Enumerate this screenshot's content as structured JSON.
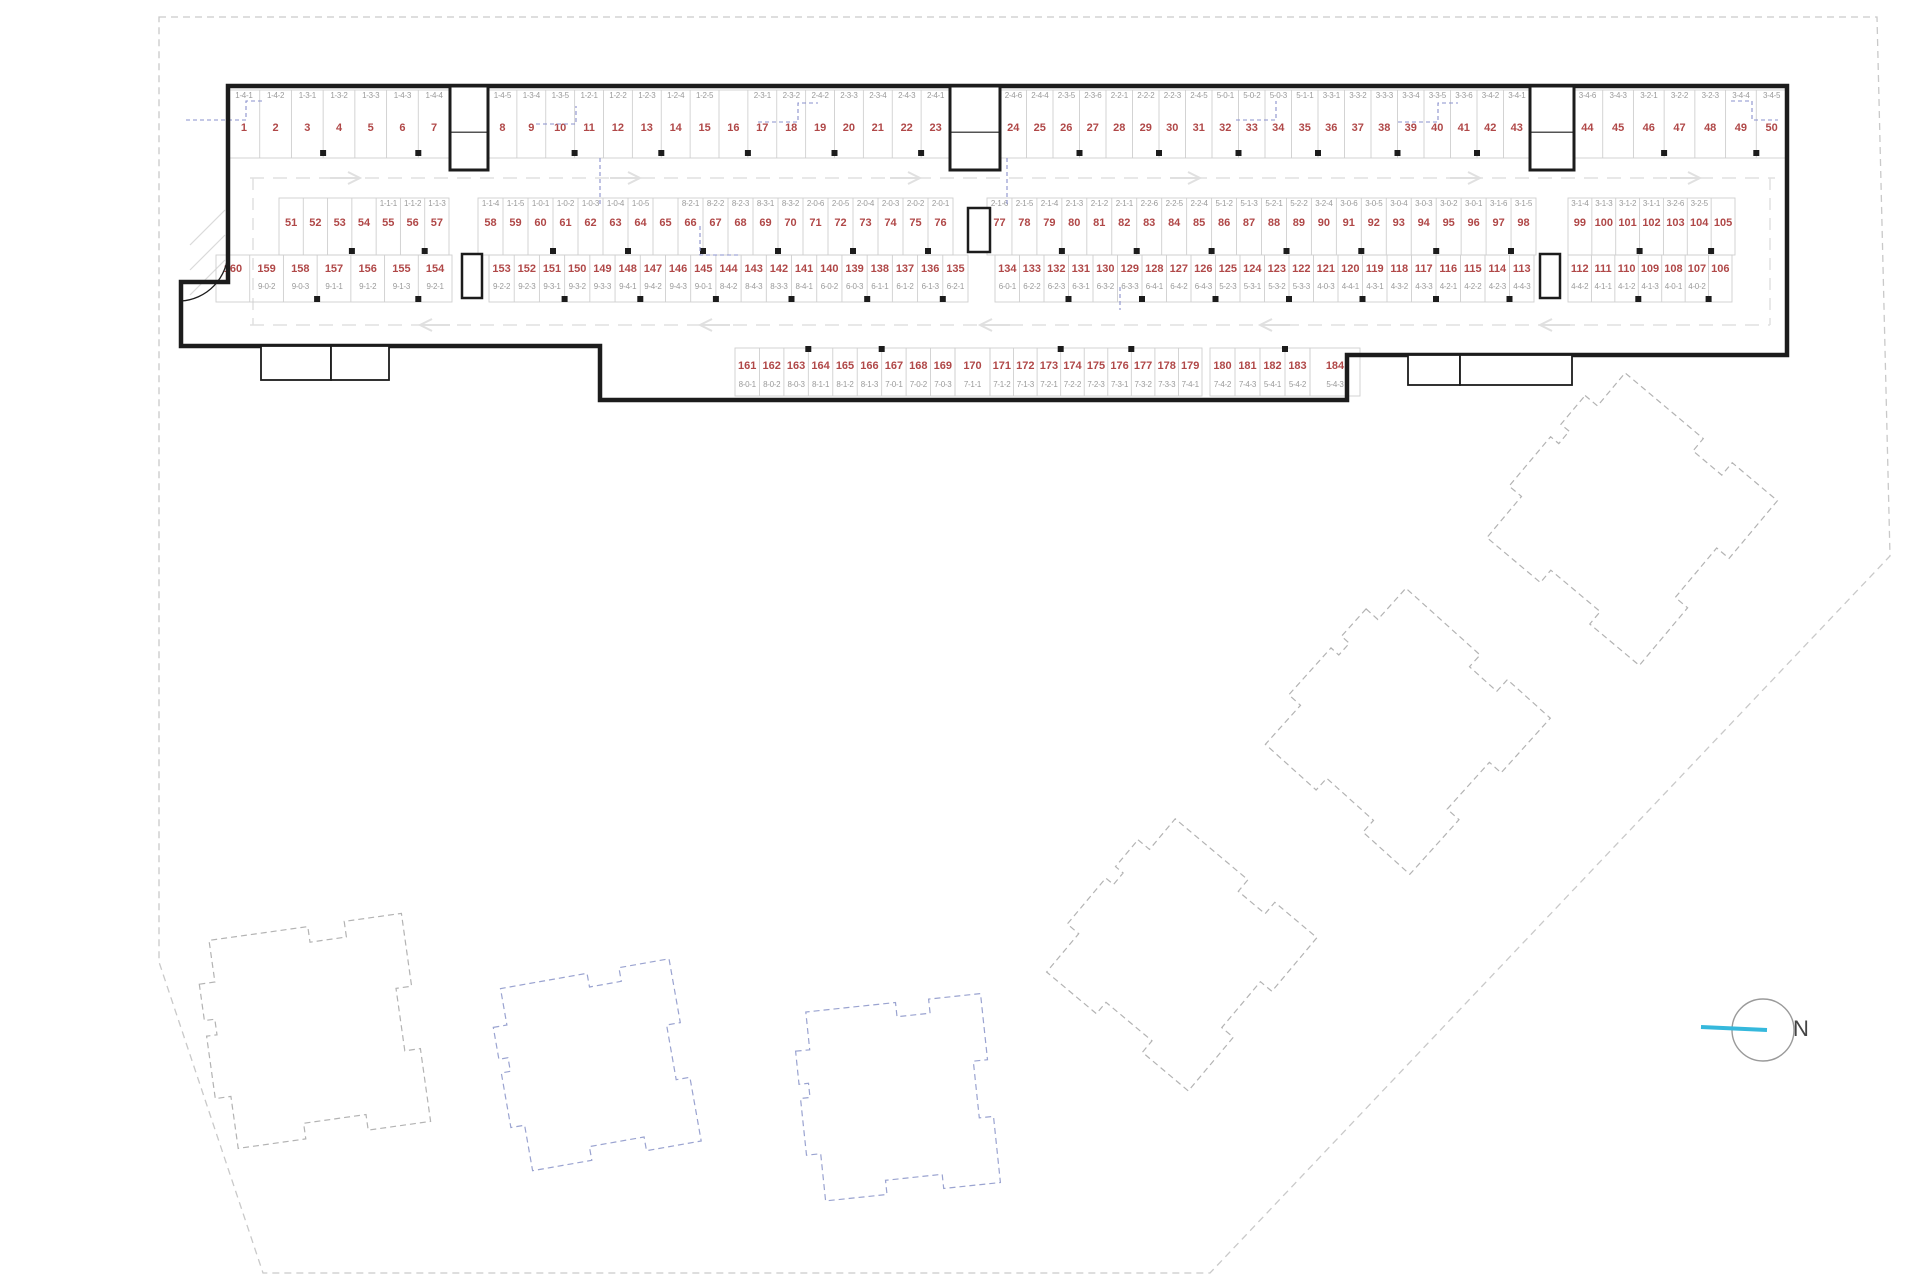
{
  "north_label": "N",
  "colors": {
    "space_number": "#b04848",
    "space_code": "#9a9a9a",
    "wall": "#1c1c1c",
    "divider": "#cfcfcf",
    "lane": "#e0e0e0",
    "blue_dash": "#8a90cc",
    "boundary": "#c9c9c9",
    "north_line": "#35b8dc",
    "building_gray": "#b3b3b3",
    "building_blue": "#9aa3d0"
  },
  "parking_rows": [
    {
      "name": "row-top",
      "num_y": 131,
      "code_y": 98,
      "div_top": 90,
      "div_bottom": 158,
      "frame_top": 88,
      "col_y": 150,
      "groups": [
        {
          "x1": 228,
          "x2": 450,
          "numbers": [
            1,
            2,
            3,
            4,
            5,
            6,
            7
          ],
          "codes": [
            "1-4-1",
            "1-4-2",
            "1-3-1",
            "1-3-2",
            "1-3-3",
            "1-4-3",
            "1-4-4"
          ]
        },
        {
          "x1": 488,
          "x2": 950,
          "numbers": [
            8,
            9,
            10,
            11,
            12,
            13,
            14,
            15,
            16,
            17,
            18,
            19,
            20,
            21,
            22,
            23
          ],
          "codes": [
            "1-4-5",
            "1-3-4",
            "1-3-5",
            "1-2-1",
            "1-2-2",
            "1-2-3",
            "1-2-4",
            "1-2-5",
            "",
            "2-3-1",
            "2-3-2",
            "2-4-2",
            "2-3-3",
            "2-3-4",
            "2-4-3",
            "2-4-1"
          ]
        },
        {
          "x1": 1000,
          "x2": 1530,
          "numbers": [
            24,
            25,
            26,
            27,
            28,
            29,
            30,
            31,
            32,
            33,
            34,
            35,
            36,
            37,
            38,
            39,
            40,
            41,
            42,
            43
          ],
          "codes": [
            "2-4-6",
            "2-4-4",
            "2-3-5",
            "2-3-6",
            "2-2-1",
            "2-2-2",
            "2-2-3",
            "2-4-5",
            "5-0-1",
            "5-0-2",
            "5-0-3",
            "5-1-1",
            "3-3-1",
            "3-3-2",
            "3-3-3",
            "3-3-4",
            "3-3-5",
            "3-3-6",
            "3-4-2",
            "3-4-1"
          ]
        },
        {
          "x1": 1572,
          "x2": 1787,
          "numbers": [
            44,
            45,
            46,
            47,
            48,
            49,
            50
          ],
          "codes": [
            "3-4-6",
            "3-4-3",
            "3-2-1",
            "3-2-2",
            "3-2-3",
            "3-4-4",
            "3-4-5"
          ]
        }
      ]
    },
    {
      "name": "row-mid-upper",
      "num_y": 226,
      "code_y": 206,
      "div_top": 198,
      "div_bottom": 255,
      "col_y": 248,
      "groups": [
        {
          "x1": 279,
          "x2": 449,
          "numbers": [
            51,
            52,
            53,
            54,
            55,
            56,
            57
          ],
          "codes": [
            "",
            "",
            "",
            "",
            "1-1-1",
            "1-1-2",
            "1-1-3"
          ]
        },
        {
          "x1": 478,
          "x2": 953,
          "numbers": [
            58,
            59,
            60,
            61,
            62,
            63,
            64,
            65,
            66,
            67,
            68,
            69,
            70,
            71,
            72,
            73,
            74,
            75,
            76
          ],
          "codes": [
            "1-1-4",
            "1-1-5",
            "1-0-1",
            "1-0-2",
            "1-0-3",
            "1-0-4",
            "1-0-5",
            "",
            "8-2-1",
            "8-2-2",
            "8-2-3",
            "8-3-1",
            "8-3-2",
            "2-0-6",
            "2-0-5",
            "2-0-4",
            "2-0-3",
            "2-0-2",
            "2-0-1"
          ]
        },
        {
          "x1": 987,
          "x2": 1536,
          "numbers": [
            77,
            78,
            79,
            80,
            81,
            82,
            83,
            84,
            85,
            86,
            87,
            88,
            89,
            90,
            91,
            92,
            93,
            94,
            95,
            96,
            97,
            98
          ],
          "codes": [
            "2-1-6",
            "2-1-5",
            "2-1-4",
            "2-1-3",
            "2-1-2",
            "2-1-1",
            "2-2-6",
            "2-2-5",
            "2-2-4",
            "5-1-2",
            "5-1-3",
            "5-2-1",
            "5-2-2",
            "3-2-4",
            "3-0-6",
            "3-0-5",
            "3-0-4",
            "3-0-3",
            "3-0-2",
            "3-0-1",
            "3-1-6",
            "3-1-5"
          ]
        },
        {
          "x1": 1568,
          "x2": 1735,
          "numbers": [
            99,
            100,
            101,
            102,
            103,
            104,
            105
          ],
          "codes": [
            "3-1-4",
            "3-1-3",
            "3-1-2",
            "3-1-1",
            "3-2-6",
            "3-2-5",
            ""
          ]
        }
      ]
    },
    {
      "name": "row-mid-lower",
      "num_y": 272,
      "code_y": 289,
      "div_top": 255,
      "div_bottom": 302,
      "col_y": 296,
      "groups": [
        {
          "x1": 216,
          "x2": 452,
          "numbers": [
            160,
            159,
            158,
            157,
            156,
            155,
            154
          ],
          "codes": [
            "",
            "9-0-2",
            "9-0-3",
            "9-1-1",
            "9-1-2",
            "9-1-3",
            "9-2-1"
          ]
        },
        {
          "x1": 489,
          "x2": 968,
          "numbers": [
            153,
            152,
            151,
            150,
            149,
            148,
            147,
            146,
            145,
            144,
            143,
            142,
            141,
            140,
            139,
            138,
            137,
            136,
            135
          ],
          "codes": [
            "9-2-2",
            "9-2-3",
            "9-3-1",
            "9-3-2",
            "9-3-3",
            "9-4-1",
            "9-4-2",
            "9-4-3",
            "9-0-1",
            "8-4-2",
            "8-4-3",
            "8-3-3",
            "8-4-1",
            "6-0-2",
            "6-0-3",
            "6-1-1",
            "6-1-2",
            "6-1-3",
            "6-2-1"
          ]
        },
        {
          "x1": 995,
          "x2": 1534,
          "numbers": [
            134,
            133,
            132,
            131,
            130,
            129,
            128,
            127,
            126,
            125,
            124,
            123,
            122,
            121,
            120,
            119,
            118,
            117,
            116,
            115,
            114,
            113
          ],
          "codes": [
            "6-0-1",
            "6-2-2",
            "6-2-3",
            "6-3-1",
            "6-3-2",
            "6-3-3",
            "6-4-1",
            "6-4-2",
            "6-4-3",
            "5-2-3",
            "5-3-1",
            "5-3-2",
            "5-3-3",
            "4-0-3",
            "4-4-1",
            "4-3-1",
            "4-3-2",
            "4-3-3",
            "4-2-1",
            "4-2-2",
            "4-2-3",
            "4-4-3"
          ]
        },
        {
          "x1": 1568,
          "x2": 1732,
          "numbers": [
            112,
            111,
            110,
            109,
            108,
            107,
            106
          ],
          "codes": [
            "4-4-2",
            "4-1-1",
            "4-1-2",
            "4-1-3",
            "4-0-1",
            "4-0-2",
            ""
          ]
        }
      ]
    },
    {
      "name": "row-bottom",
      "num_y": 369,
      "code_y": 387,
      "div_top": 348,
      "div_bottom": 396,
      "col_y": 346,
      "groups": [
        {
          "x1": 735,
          "x2": 955,
          "numbers": [
            161,
            162,
            163,
            164,
            165,
            166,
            167,
            168,
            169
          ],
          "codes": [
            "8-0-1",
            "8-0-2",
            "8-0-3",
            "8-1-1",
            "8-1-2",
            "8-1-3",
            "7-0-1",
            "7-0-2",
            "7-0-3"
          ]
        },
        {
          "x1": 955,
          "x2": 990,
          "numbers": [
            170
          ],
          "codes": [
            "7-1-1"
          ]
        },
        {
          "x1": 990,
          "x2": 1202,
          "numbers": [
            171,
            172,
            173,
            174,
            175,
            176,
            177,
            178,
            179
          ],
          "codes": [
            "7-1-2",
            "7-1-3",
            "7-2-1",
            "7-2-2",
            "7-2-3",
            "7-3-1",
            "7-3-2",
            "7-3-3",
            "7-4-1"
          ]
        },
        {
          "x1": 1210,
          "x2": 1310,
          "numbers": [
            180,
            181,
            182,
            183
          ],
          "codes": [
            "7-4-2",
            "7-4-3",
            "5-4-1",
            "5-4-2"
          ]
        },
        {
          "x1": 1310,
          "x2": 1360,
          "numbers": [
            184
          ],
          "codes": [
            "5-4-3"
          ]
        }
      ]
    }
  ],
  "geometry": {
    "site_boundary": [
      [
        159,
        17
      ],
      [
        1877,
        17
      ],
      [
        1890,
        556
      ],
      [
        1210,
        1273
      ],
      [
        263,
        1273
      ],
      [
        159,
        962
      ]
    ],
    "garage_outline": [
      [
        228,
        86
      ],
      [
        1787,
        86
      ],
      [
        1787,
        355
      ],
      [
        1347,
        355
      ],
      [
        1347,
        400
      ],
      [
        600,
        400
      ],
      [
        600,
        346
      ],
      [
        181,
        346
      ],
      [
        181,
        282
      ],
      [
        228,
        282
      ]
    ],
    "cores": [
      [
        450,
        86,
        38,
        84
      ],
      [
        950,
        86,
        50,
        84
      ],
      [
        1530,
        86,
        44,
        84
      ]
    ],
    "shafts": [
      [
        462,
        254,
        20,
        44
      ],
      [
        968,
        208,
        22,
        44
      ],
      [
        1540,
        254,
        20,
        44
      ]
    ],
    "rooms": [
      [
        261,
        346,
        70,
        34
      ],
      [
        331,
        346,
        58,
        34
      ],
      [
        1408,
        355,
        52,
        30
      ],
      [
        1460,
        355,
        112,
        30
      ]
    ],
    "lanes": [
      {
        "y": 178,
        "x1": 250,
        "x2": 1775,
        "arrows": [
          360,
          640,
          920,
          1200,
          1480,
          1700
        ],
        "dir": -1
      },
      {
        "y": 325,
        "x1": 250,
        "x2": 1770,
        "arrows": [
          420,
          700,
          980,
          1260,
          1540
        ],
        "dir": 1
      }
    ],
    "lane_verticals": [
      {
        "x": 253,
        "y1": 178,
        "y2": 325
      },
      {
        "x": 1770,
        "y1": 178,
        "y2": 325
      }
    ],
    "ramp_hatch": [
      [
        190,
        295,
        225,
        260
      ],
      [
        190,
        270,
        225,
        235
      ],
      [
        190,
        245,
        225,
        210
      ]
    ],
    "door_arc": "M 228 252 A 50 50 0 0 1 181 301",
    "blue_accents": [
      [
        [
          186,
          120
        ],
        [
          246,
          120
        ],
        [
          246,
          101
        ],
        [
          263,
          101
        ]
      ],
      [
        [
          536,
          124
        ],
        [
          576,
          124
        ],
        [
          576,
          106
        ]
      ],
      [
        [
          758,
          122
        ],
        [
          798,
          122
        ],
        [
          798,
          103
        ],
        [
          818,
          103
        ]
      ],
      [
        [
          1236,
          120
        ],
        [
          1276,
          120
        ],
        [
          1276,
          101
        ]
      ],
      [
        [
          1398,
          122
        ],
        [
          1438,
          122
        ],
        [
          1438,
          103
        ],
        [
          1458,
          103
        ]
      ],
      [
        [
          1731,
          101
        ],
        [
          1752,
          101
        ],
        [
          1752,
          120
        ],
        [
          1778,
          120
        ]
      ],
      [
        [
          600,
          158
        ],
        [
          600,
          206
        ]
      ],
      [
        [
          1007,
          158
        ],
        [
          1007,
          206
        ]
      ],
      [
        [
          700,
          226
        ],
        [
          700,
          255
        ],
        [
          740,
          255
        ]
      ],
      [
        [
          1120,
          287
        ],
        [
          1120,
          310
        ]
      ]
    ],
    "buildings": [
      {
        "cx": 312,
        "cy": 1032,
        "size": 210,
        "rot": -8,
        "color": "gray"
      },
      {
        "cx": 594,
        "cy": 1066,
        "size": 185,
        "rot": -10,
        "color": "blue"
      },
      {
        "cx": 896,
        "cy": 1098,
        "size": 190,
        "rot": -6,
        "color": "blue"
      },
      {
        "cx": 1176,
        "cy": 950,
        "size": 200,
        "rot": 40,
        "color": "gray"
      },
      {
        "cx": 1402,
        "cy": 726,
        "size": 210,
        "rot": 42,
        "color": "gray"
      },
      {
        "cx": 1626,
        "cy": 514,
        "size": 215,
        "rot": 40,
        "color": "gray"
      }
    ],
    "north": {
      "cx": 1763,
      "cy": 1030,
      "r": 31,
      "label_x": 1793,
      "label_y": 1016
    }
  }
}
